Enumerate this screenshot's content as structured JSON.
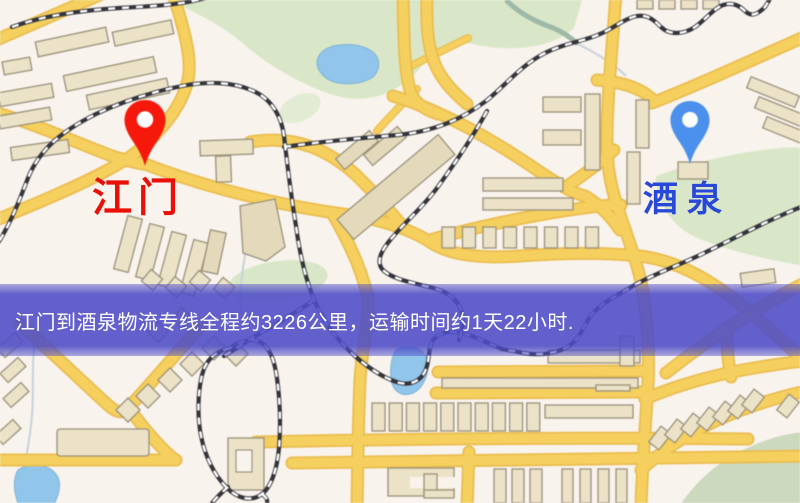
{
  "markers": {
    "origin": {
      "label": "江门",
      "pin_color": "#ef1a0c",
      "label_color": "#e81008"
    },
    "destination": {
      "label": "酒泉",
      "pin_color": "#4d90e8",
      "label_color": "#2948d8"
    }
  },
  "banner": {
    "text": "江门到酒泉物流专线全程约3226公里，运输时间约1天22小时.",
    "background_color": "#4e4cc7",
    "text_color": "#ffffff"
  },
  "icons": {
    "origin_pin": "map-pin-icon",
    "destination_pin": "map-pin-icon"
  },
  "map_palette": {
    "background": "#f8f3ed",
    "road_fill": "#f4d063",
    "road_casing": "#e8bc52",
    "building_fill": "#ebe2c8",
    "building_outline": "#9a917c",
    "park_green": "#d9e7c9",
    "park_green_muted": "#cdd9c0",
    "water_blue": "#93c6e8",
    "railway_dark": "#34343b"
  }
}
